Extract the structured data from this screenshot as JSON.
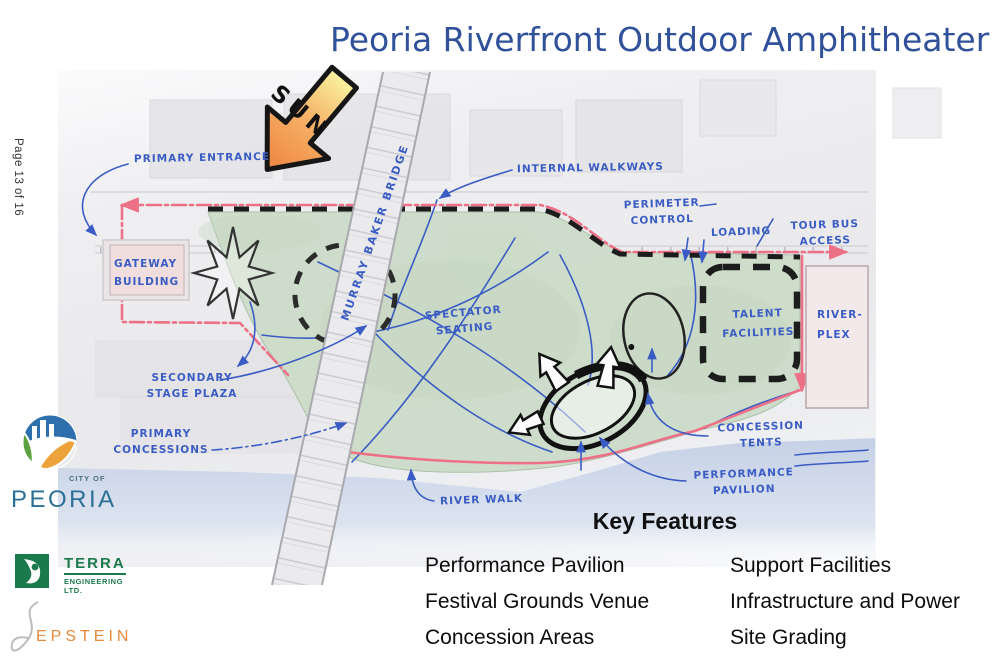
{
  "page": {
    "title": "Peoria Riverfront Outdoor Amphitheater",
    "indicator": "Page 13 of 16"
  },
  "map": {
    "labels": {
      "sun": "SUN",
      "primary_entrance": "PRIMARY ENTRANCE",
      "internal_walkways": "INTERNAL WALKWAYS",
      "perimeter_control": "PERIMETER CONTROL",
      "loading": "LOADING",
      "tour_bus_access": "TOUR BUS ACCESS",
      "gateway_building": "GATEWAY BUILDING",
      "murray_baker_bridge": "MURRAY BAKER BRIDGE",
      "spectator_seating": "SPECTATOR SEATING",
      "talent_facilities": "TALENT FACILITIES",
      "river_plex": "RIVER-PLEX",
      "secondary_stage_plaza": "SECONDARY STAGE PLAZA",
      "primary_concessions": "PRIMARY CONCESSIONS",
      "concession_tents": "CONCESSION TENTS",
      "performance_pavilion": "PERFORMANCE PAVILION",
      "river_walk": "RIVER WALK"
    }
  },
  "logos": {
    "peoria": {
      "city_of": "CITY OF",
      "name": "PEORIA"
    },
    "terra": {
      "name": "TERRA",
      "subtitle": "ENGINEERING LTD."
    },
    "epstein": {
      "name": "EPSTEIN"
    }
  },
  "key_features": {
    "heading": "Key Features",
    "col1": [
      "Performance Pavilion",
      "Festival Grounds Venue",
      "Concession Areas"
    ],
    "col2": [
      "Support Facilities",
      "Infrastructure and Power",
      "Site Grading"
    ]
  },
  "colors": {
    "title_blue": "#31519b",
    "ink_blue": "#3a5cc4",
    "site_pink": "#ee7086",
    "lawn_green": "#cddcc9",
    "water_blue": "#c6d2e6",
    "peoria_teal": "#2a7095",
    "terra_green": "#1b7a4b",
    "epstein_orange": "#e2893c"
  }
}
